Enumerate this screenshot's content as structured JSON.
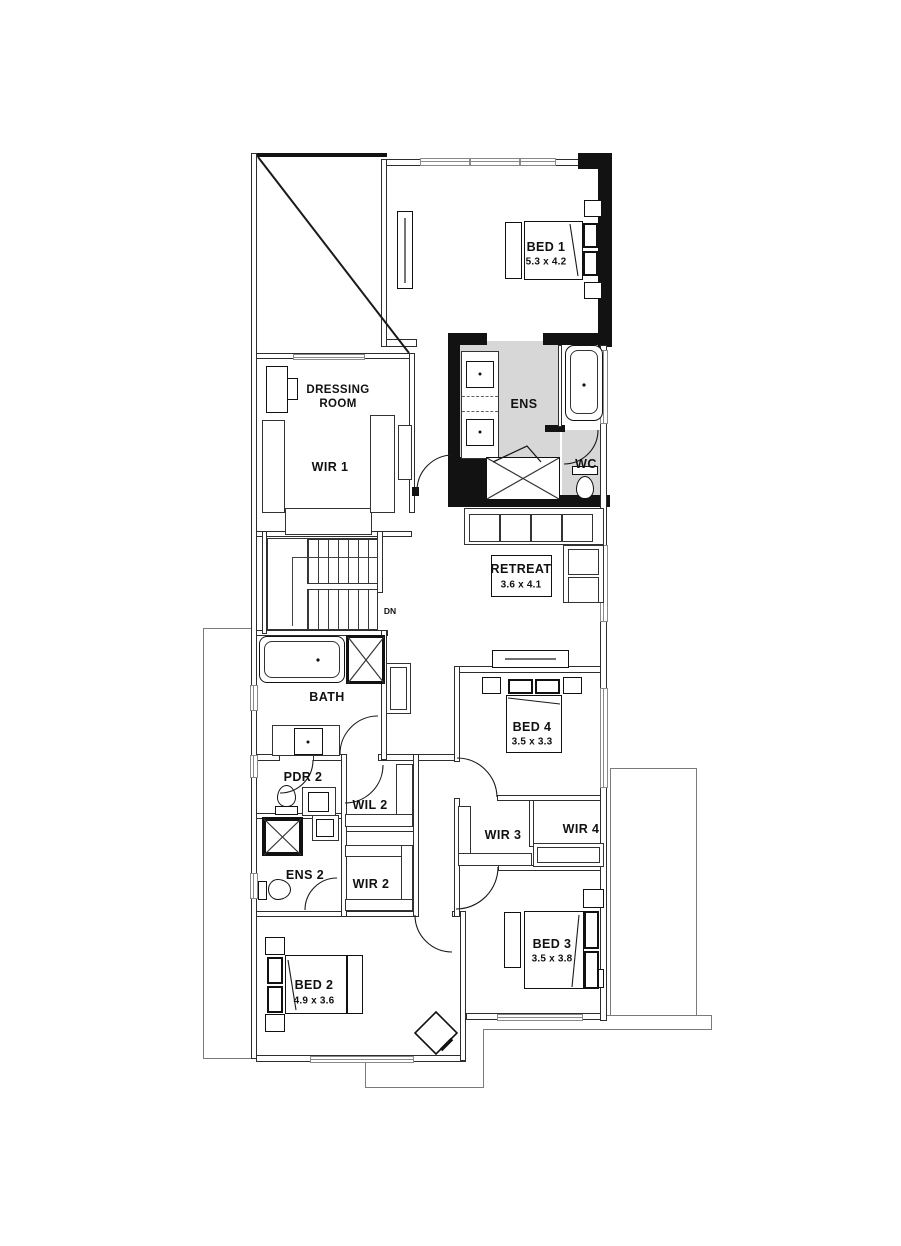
{
  "plan": {
    "title": "Upper floor plan",
    "colors": {
      "wall_black": "#121212",
      "wall_line": "#2d2d2d",
      "ens_floor": "#d7d7d7",
      "window_line": "#8a8a8a",
      "roof_outline": "#7a7a7a"
    },
    "rooms": {
      "bed1": {
        "name": "BED 1",
        "dims": "5.3 x 4.2"
      },
      "dressing_room": {
        "line1": "DRESSING",
        "line2": "ROOM"
      },
      "wir1": {
        "name": "WIR 1"
      },
      "ens": {
        "name": "ENS"
      },
      "wc": {
        "name": "WC"
      },
      "retreat": {
        "name": "RETREAT",
        "dims": "3.6 x 4.1"
      },
      "stairs": {
        "direction": "DN"
      },
      "bath": {
        "name": "BATH"
      },
      "bed4": {
        "name": "BED 4",
        "dims": "3.5 x 3.3"
      },
      "pdr2": {
        "name": "PDR 2"
      },
      "wil2": {
        "name": "WIL 2"
      },
      "wir2": {
        "name": "WIR 2"
      },
      "wir3": {
        "name": "WIR 3"
      },
      "wir4": {
        "name": "WIR 4"
      },
      "ens2": {
        "name": "ENS 2"
      },
      "bed3": {
        "name": "BED 3",
        "dims": "3.5 x 3.8"
      },
      "bed2": {
        "name": "BED 2",
        "dims": "4.9 x 3.6"
      }
    }
  }
}
